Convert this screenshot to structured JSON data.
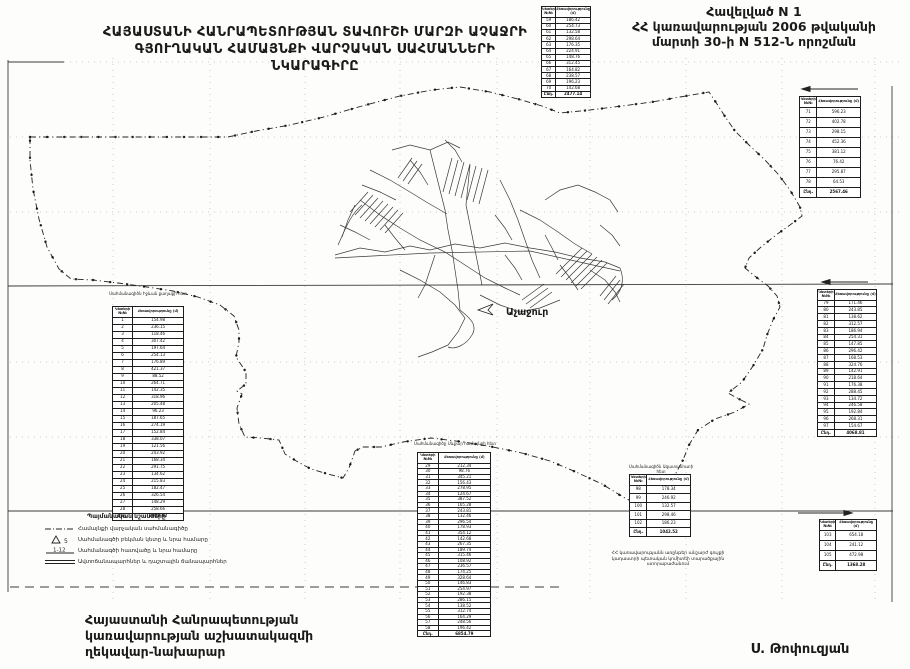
{
  "header": {
    "title_line1": "ՀԱՅԱՍՏԱՆԻ ՀԱՆՐԱՊԵՏՈՒԹՅԱՆ ՏԱՎՈՒՇԻ ՄԱՐԶԻ ԱՉԱՋՐԻ",
    "title_line2": "ԳՅՈՒՂԱԿԱՆ ՀԱՄԱՅՆՔԻ ՎԱՐՉԱԿԱՆ ՍԱՀՄԱՆՆԵՐԻ ՆԿԱՐԱԳԻՐԸ",
    "annex_line1": "Հավելված N 1",
    "annex_line2": "ՀՀ կառավարության 2006 թվականի",
    "annex_line3": "մարտի 30-ի N 512-Ն որոշման"
  },
  "map": {
    "village_label": "Աչաջուր"
  },
  "legend": {
    "title": "Պայմանական նշանները",
    "items": [
      {
        "symbol": "dash-dot-line",
        "symbol_text": "",
        "label": "Համայնքի վարչական սահմանագիծը"
      },
      {
        "symbol": "triangle-point",
        "symbol_text": "5",
        "label": "Սահմանագծի բեկման կետը և նրա համարը"
      },
      {
        "symbol": "segment-numbers",
        "symbol_text": "1-12",
        "label": "Սահմանագծի հատվածը և նրա համարը"
      },
      {
        "symbol": "double-line",
        "symbol_text": "",
        "label": "Ավտոճանապարհներ և դաշտային ճանապարհներ"
      }
    ]
  },
  "note": {
    "line1": "ՀՀ կառավարությանն առընթեր անշարժ գույքի",
    "line2": "կադաստրի պետական կոմիտեի տարածքային",
    "line3": "ստորաբաժանում"
  },
  "footer": {
    "left_line1": "Հայաստանի Հանրապետության",
    "left_line2": "կառավարության աշխատակազմի",
    "left_line3": "ղեկավար-նախարար",
    "signature": "Ս. Թոփուզյան"
  },
  "captions": {
    "left_table": "Սահմանագիծն Իջևան քաղաքի հետ",
    "bottom_table": "Սահմանագիծը Սևքար համայնքի հետ",
    "right_small_table": "Սահմանագիծն Ազատամուտի հետ"
  },
  "tables": {
    "top_center": {
      "headers": [
        "Կետերի №№",
        "Հեռավորությունը (մ)"
      ],
      "rows": [
        [
          "59",
          "186.42"
        ],
        [
          "60",
          "254.73"
        ],
        [
          "61",
          "132.58"
        ],
        [
          "62",
          "298.64"
        ],
        [
          "63",
          "176.35"
        ],
        [
          "64",
          "224.91"
        ],
        [
          "65",
          "148.76"
        ],
        [
          "66",
          "312.45"
        ],
        [
          "67",
          "164.82"
        ],
        [
          "68",
          "238.57"
        ],
        [
          "69",
          "196.23"
        ],
        [
          "70",
          "142.68"
        ]
      ],
      "total": [
        "Ընդ.",
        "2477.14"
      ]
    },
    "right_upper": {
      "headers": [
        "Կետերի №№",
        "Հեռավորությունը (մ)"
      ],
      "rows": [
        [
          "71",
          "596.23"
        ],
        [
          "72",
          "402.78"
        ],
        [
          "73",
          "298.15"
        ],
        [
          "74",
          "452.36"
        ],
        [
          "75",
          "381.12"
        ],
        [
          "76",
          "76.42"
        ],
        [
          "77",
          "295.87"
        ],
        [
          "78",
          "64.53"
        ]
      ],
      "total": [
        "Ընդ.",
        "2567.46"
      ]
    },
    "left": {
      "headers": [
        "Կետերի №№",
        "Հեռավորությունը (մ)"
      ],
      "rows": [
        [
          "1",
          "154.98"
        ],
        [
          "2",
          "236.15"
        ],
        [
          "3",
          "118.46"
        ],
        [
          "4",
          "307.42"
        ],
        [
          "5",
          "197.64"
        ],
        [
          "6",
          "254.13"
        ],
        [
          "7",
          "176.89"
        ],
        [
          "8",
          "421.37"
        ],
        [
          "9",
          "88.52"
        ],
        [
          "10",
          "264.71"
        ],
        [
          "11",
          "142.35"
        ],
        [
          "12",
          "318.96"
        ],
        [
          "13",
          "205.48"
        ],
        [
          "14",
          "96.23"
        ],
        [
          "15",
          "187.65"
        ],
        [
          "16",
          "274.19"
        ],
        [
          "17",
          "152.84"
        ],
        [
          "18",
          "338.07"
        ],
        [
          "19",
          "121.56"
        ],
        [
          "20",
          "243.92"
        ],
        [
          "21",
          "168.34"
        ],
        [
          "22",
          "291.75"
        ],
        [
          "23",
          "134.62"
        ],
        [
          "24",
          "215.83"
        ],
        [
          "25",
          "182.47"
        ],
        [
          "26",
          "326.54"
        ],
        [
          "27",
          "148.29"
        ],
        [
          "28",
          "258.66"
        ]
      ],
      "total": [
        "Ընդ.",
        "6028.02"
      ]
    },
    "bottom_middle": {
      "headers": [
        "Կետերի №№",
        "Հեռավորությունը (մ)"
      ],
      "rows": [
        [
          "29",
          "212.34"
        ],
        [
          "30",
          "98.76"
        ],
        [
          "31",
          "345.21"
        ],
        [
          "32",
          "156.43"
        ],
        [
          "33",
          "278.95"
        ],
        [
          "34",
          "124.67"
        ],
        [
          "35",
          "387.52"
        ],
        [
          "36",
          "165.28"
        ],
        [
          "37",
          "243.81"
        ],
        [
          "38",
          "132.46"
        ],
        [
          "39",
          "296.54"
        ],
        [
          "40",
          "178.93"
        ],
        [
          "41",
          "354.12"
        ],
        [
          "42",
          "142.68"
        ],
        [
          "43",
          "267.35"
        ],
        [
          "44",
          "189.74"
        ],
        [
          "45",
          "315.46"
        ],
        [
          "46",
          "108.92"
        ],
        [
          "47",
          "236.57"
        ],
        [
          "48",
          "174.25"
        ],
        [
          "49",
          "328.64"
        ],
        [
          "50",
          "146.83"
        ],
        [
          "51",
          "254.97"
        ],
        [
          "52",
          "192.38"
        ],
        [
          "53",
          "286.15"
        ],
        [
          "54",
          "138.52"
        ],
        [
          "55",
          "312.74"
        ],
        [
          "56",
          "164.29"
        ],
        [
          "57",
          "248.56"
        ],
        [
          "58",
          "196.42"
        ]
      ],
      "total": [
        "Ընդ.",
        "6854.79"
      ]
    },
    "right_mid": {
      "headers": [
        "Կետերի №№",
        "Հեռավորությունը (մ)"
      ],
      "rows": [
        [
          "79",
          "171.46"
        ],
        [
          "80",
          "243.85"
        ],
        [
          "81",
          "138.62"
        ],
        [
          "82",
          "312.57"
        ],
        [
          "83",
          "186.94"
        ],
        [
          "84",
          "254.31"
        ],
        [
          "85",
          "147.85"
        ],
        [
          "86",
          "296.42"
        ],
        [
          "87",
          "168.53"
        ],
        [
          "88",
          "324.76"
        ],
        [
          "89",
          "142.91"
        ],
        [
          "90",
          "218.64"
        ],
        [
          "91",
          "176.38"
        ],
        [
          "92",
          "288.45"
        ],
        [
          "93",
          "134.72"
        ],
        [
          "94",
          "246.58"
        ],
        [
          "95",
          "192.84"
        ],
        [
          "96",
          "268.31"
        ],
        [
          "97",
          "154.67"
        ]
      ],
      "total": [
        "Ընդ.",
        "4068.81"
      ]
    },
    "right_small": {
      "headers": [
        "Կետերի №№",
        "Հեռավորությունը (մ)"
      ],
      "rows": [
        [
          "98",
          "178.34"
        ],
        [
          "99",
          "246.92"
        ],
        [
          "100",
          "132.57"
        ],
        [
          "101",
          "298.46"
        ],
        [
          "102",
          "186.23"
        ]
      ],
      "total": [
        "Ընդ.",
        "1042.52"
      ]
    },
    "bottom_right": {
      "headers": [
        "Կետերի №№",
        "Հեռավորությունը (մ)"
      ],
      "rows": [
        [
          "103",
          "654.18"
        ],
        [
          "104",
          "241.12"
        ],
        [
          "105",
          "472.98"
        ]
      ],
      "total": [
        "Ընդ.",
        "1368.28"
      ]
    }
  }
}
